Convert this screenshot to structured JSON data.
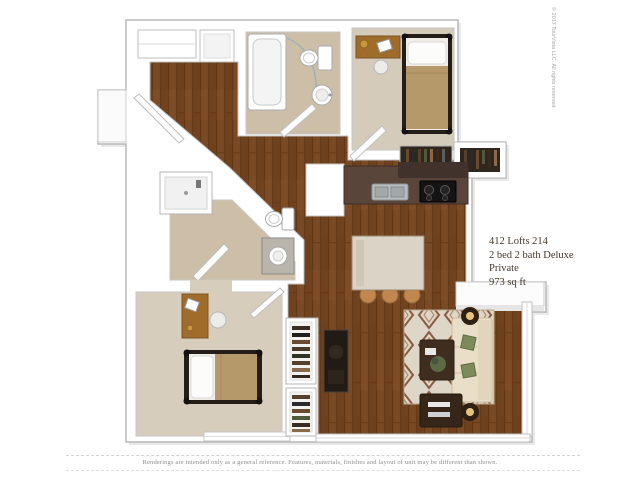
{
  "unit_info": {
    "line1": "412 Lofts 214",
    "line2": "2 bed 2 bath Deluxe",
    "line3": "Private",
    "line4": "973 sq ft"
  },
  "disclaimer": "Renderings are intended only as a general reference. Features, materials, finishes and layout of unit may be different than shown.",
  "copyright": "© 2017 TourVista LLC. All rights reserved",
  "colors": {
    "wood_floor": "#7a4a26",
    "carpet": "#d4cbbb",
    "bath_floor": "#cdbfa7",
    "kitchen_counter": "#5a453a",
    "island": "#dbd3c5",
    "rug_base": "#ded6c6",
    "rug_accent": "#8a5a44",
    "sofa": "#e9dfc8",
    "bed_blanket": "#b5996b",
    "desk_wood": "#a06c2c",
    "dark_furniture": "#3f2d20",
    "wall": "#ffffff",
    "wall_outline": "#b8b8b8"
  }
}
